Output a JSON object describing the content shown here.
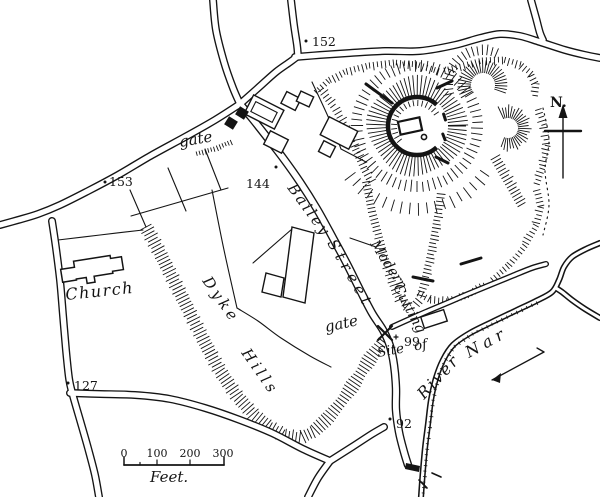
{
  "colors": {
    "ink": "#141414",
    "paper": "#ffffff"
  },
  "map": {
    "labels": {
      "gate_upper": "gate",
      "gate_lower": "gate",
      "bailey": "Bailey",
      "street": "Street",
      "modern": "Modern",
      "cutting": "Cutting",
      "site_of": "Site of",
      "church": "Church",
      "dyke": "Dyke",
      "hills": "Hills",
      "river": "River",
      "nar": "Nar"
    },
    "north_arrow": {
      "label": "N."
    },
    "spot_heights": [
      "152",
      "153",
      "144",
      "127",
      "99",
      "92"
    ],
    "scale_bar": {
      "ticks": [
        "0",
        "100",
        "200",
        "300"
      ],
      "unit": "Feet."
    }
  }
}
